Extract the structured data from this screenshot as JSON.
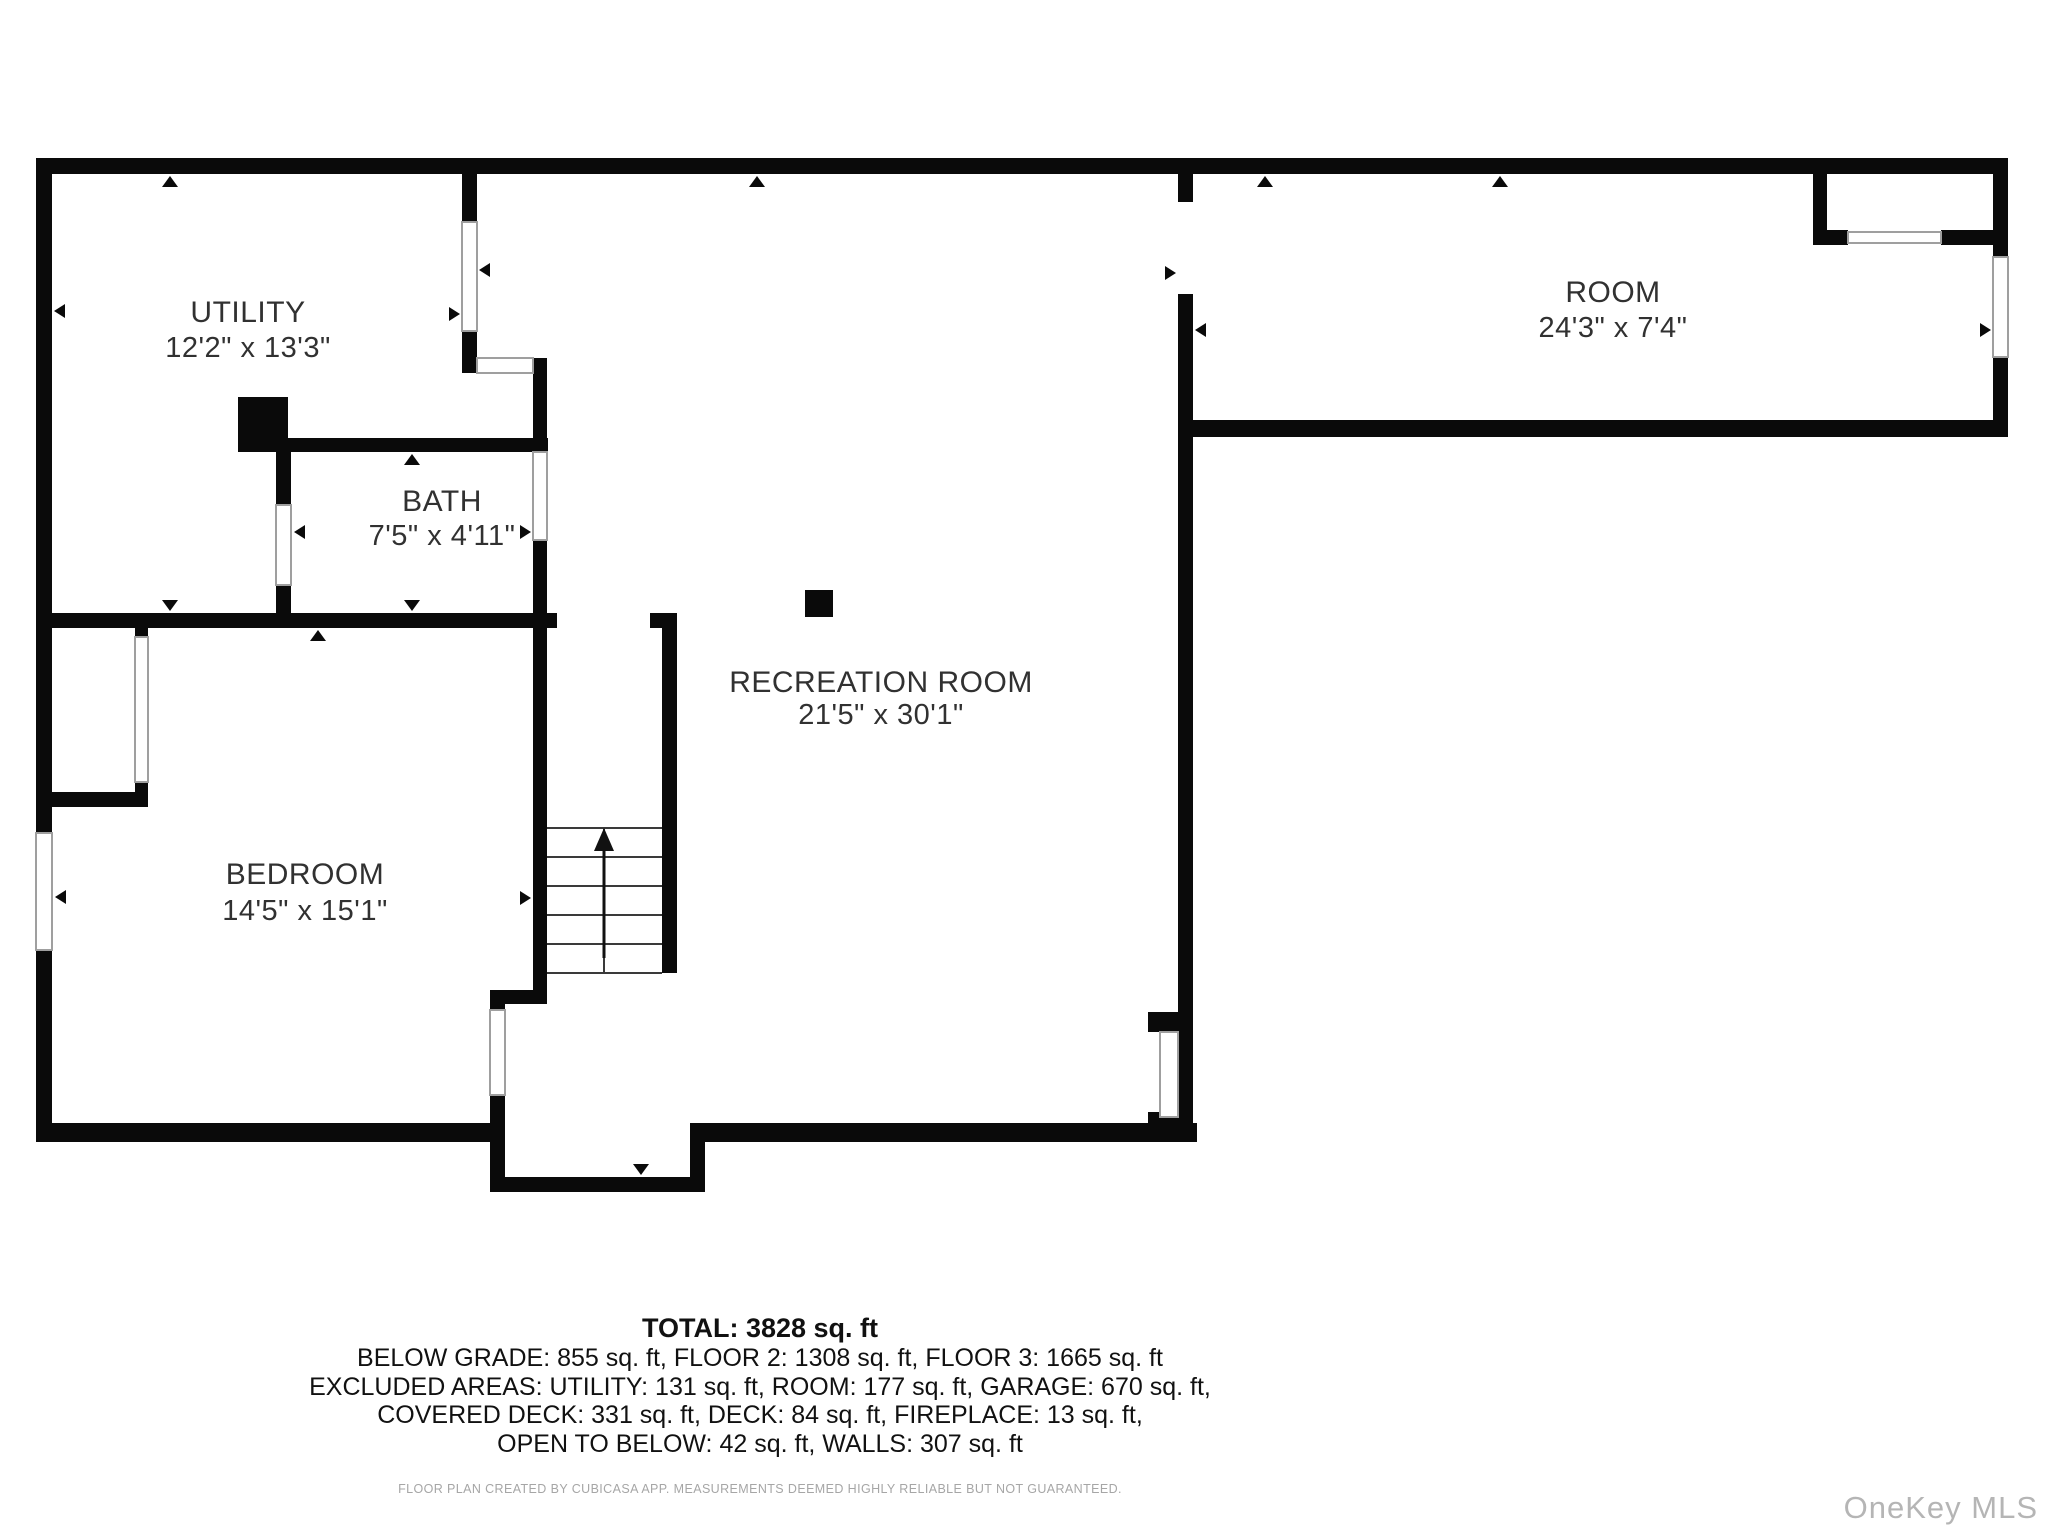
{
  "floor_plan": {
    "rooms": {
      "utility": {
        "name": "UTILITY",
        "dims": "12'2\" x 13'3\""
      },
      "bath": {
        "name": "BATH",
        "dims": "7'5\" x 4'11\""
      },
      "bedroom": {
        "name": "BEDROOM",
        "dims": "14'5\" x 15'1\""
      },
      "recreation": {
        "name": "RECREATION ROOM",
        "dims": "21'5\" x 30'1\""
      },
      "room": {
        "name": "ROOM",
        "dims": "24'3\" x 7'4\""
      }
    }
  },
  "summary": {
    "total": "TOTAL: 3828 sq. ft",
    "line1": "BELOW GRADE: 855 sq. ft, FLOOR 2: 1308 sq. ft, FLOOR 3: 1665 sq. ft",
    "line2": "EXCLUDED AREAS: UTILITY: 131 sq. ft, ROOM: 177 sq. ft, GARAGE: 670 sq. ft,",
    "line3": "COVERED DECK: 331 sq. ft, DECK: 84 sq. ft, FIREPLACE: 13 sq. ft,",
    "line4": "OPEN TO BELOW: 42 sq. ft, WALLS: 307 sq. ft"
  },
  "disclaimer": "FLOOR PLAN CREATED BY CUBICASA APP. MEASUREMENTS DEEMED HIGHLY RELIABLE BUT NOT GUARANTEED.",
  "watermark": "OneKey MLS",
  "colors": {
    "wall": "#0a0a0a",
    "label_text": "#313131",
    "window_frame": "#9f9f9f",
    "stair_line": "#3a3a3a",
    "disclaimer": "#a6a6a6",
    "watermark": "#b5b5b5"
  }
}
